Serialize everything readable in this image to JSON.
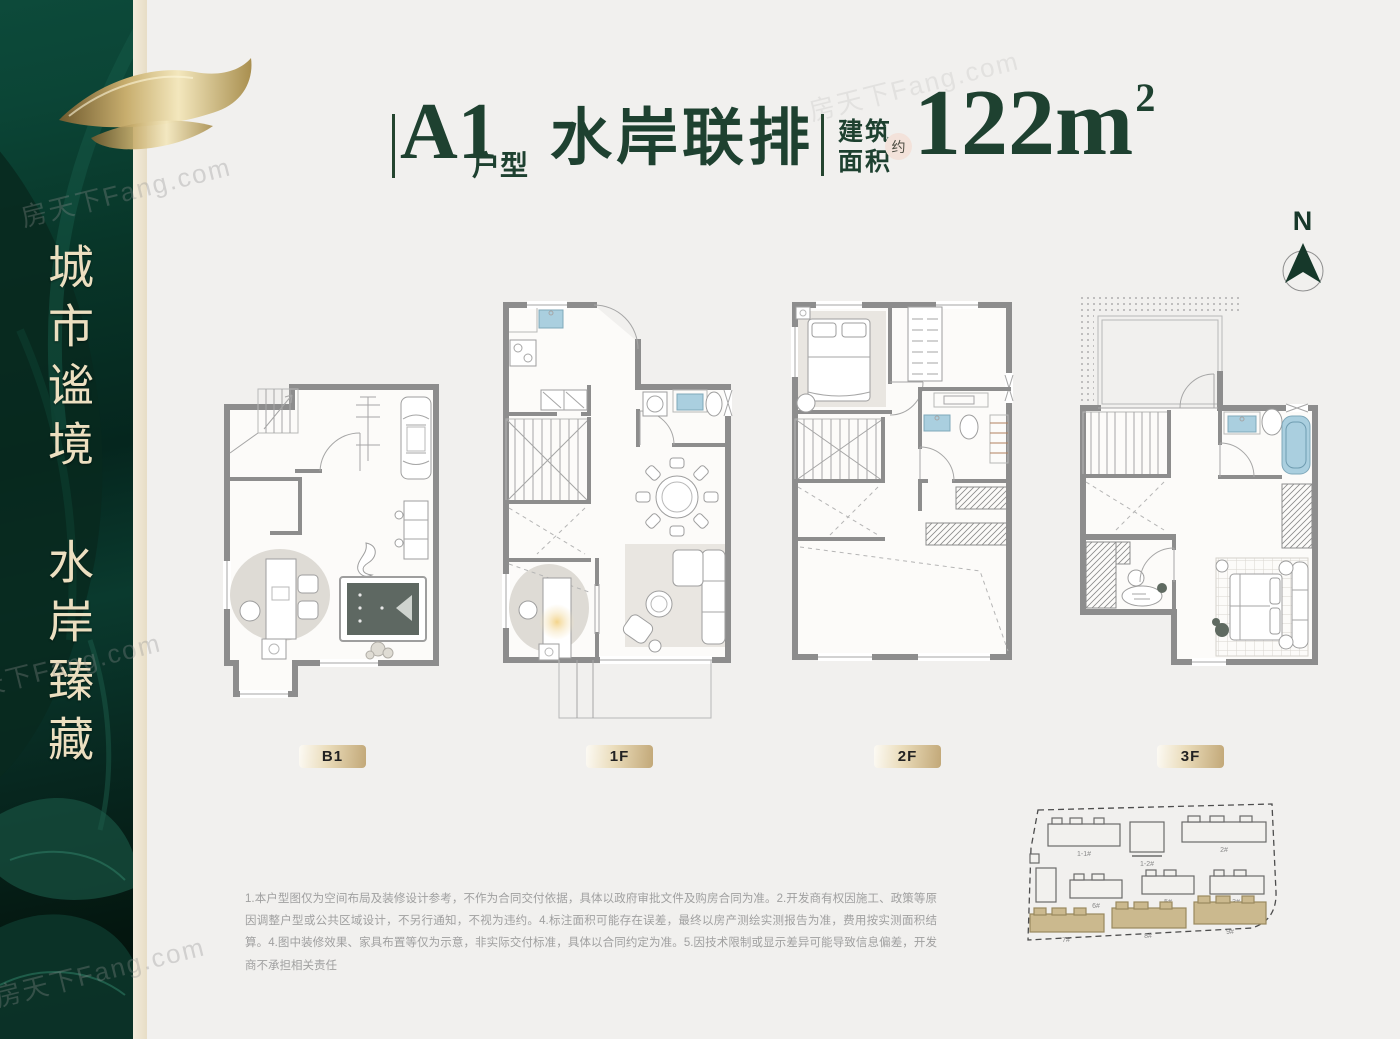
{
  "watermark": "房天下Fang.com",
  "sidebar": {
    "slogan_top": "城市谧境",
    "slogan_bottom": "水岸臻藏"
  },
  "header": {
    "unit_code": "A1",
    "unit_suffix": "户型",
    "product_name": "水岸联排",
    "area_label_top": "建筑",
    "area_label_bottom": "面积",
    "approx_badge": "约",
    "area_value": "122m",
    "area_exponent": "2"
  },
  "compass": {
    "north_label": "N"
  },
  "floors": [
    {
      "label": "B1"
    },
    {
      "label": "1F"
    },
    {
      "label": "2F"
    },
    {
      "label": "3F"
    }
  ],
  "disclaimer": "1.本户型图仅为空间布局及装修设计参考，不作为合同交付依据，具体以政府审批文件及购房合同为准。2.开发商有权因施工、政策等原因调整户型或公共区域设计，不另行通知，不视为违约。4.标注面积可能存在误差，最终以房产测绘实测报告为准，费用按实测面积结算。4.图中装修效果、家具布置等仅为示意，非实际交付标准，具体以合同约定为准。5.因技术限制或显示差异可能导致信息偏差，开发商不承担相关责任",
  "site_plan": {
    "building_labels": [
      "1-1#",
      "1-2#",
      "2#",
      "6#",
      "5#",
      "3#",
      "7#",
      "8#",
      "9#"
    ]
  },
  "colors": {
    "brand_green": "#1e4130",
    "badge_tan": "#c9b183",
    "approx_pink": "#f3e2da",
    "fixture_blue": "#aacfdf"
  }
}
